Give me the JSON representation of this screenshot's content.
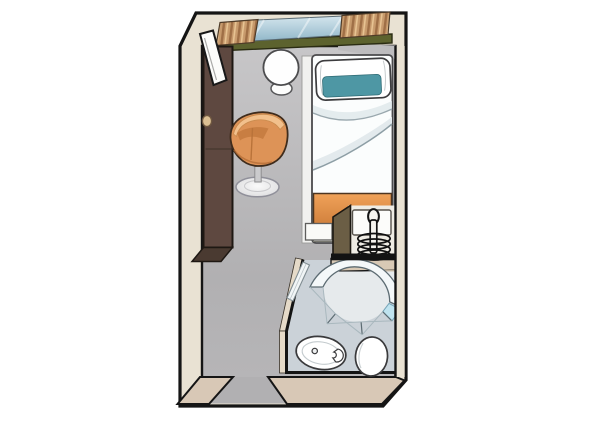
{
  "palette": {
    "background": "#ffffff",
    "wall_fill": "#e9e2d3",
    "wall_outline": "#151515",
    "wall_bottom": "#d8c8b6",
    "floor_top": "#c7c6c8",
    "floor_bottom": "#b1b0b2",
    "inner_face_gray": "#bdbcbe",
    "window_glass_top": "#d5e6ee",
    "window_glass_bottom": "#8fb6c8",
    "window_sill": "#5c622e",
    "curtain_base": "#c79a6c",
    "curtain_stripe": "#9f6f46",
    "curtain_light": "#e7c392",
    "wardrobe": "#5e4840",
    "wardrobe_face": "#4a3a31",
    "knob": "#dcc093",
    "door_white": "#fcfcfa",
    "table_white": "#fefefe",
    "chair_body": "#dd9357",
    "chair_rim": "#f2c08c",
    "chair_seat_shadow": "#c47a3e",
    "chair_outline": "#3f2c1c",
    "pedestal": "#efeff0",
    "bed_white": "#fbfdfd",
    "bed_rail": "#f1f1ef",
    "crease": "#8d9ea5",
    "pillow_teal": "#4e97a4",
    "foot_orange_1": "#f0a259",
    "foot_orange_2": "#cb7a37",
    "radiator_olive": "#6b5e45",
    "radiator_interior": "#efece4",
    "coil_black": "#101010",
    "bath_wall": "#d8c9b5",
    "bath_wall_light": "#e5dac8",
    "bath_wall_dark": "#cfc0ab",
    "bath_floor": "#cbd2d8",
    "glass_tint": "#f4f8f9",
    "glass_line": "#5c6b72",
    "glass_cross": "#a9b8be",
    "glass_cyan": "#bfe3ef",
    "fixture_white": "#ffffff",
    "fixture_outline": "#3a3a3c"
  },
  "scene": {
    "type": "cabin-floorplan-illustration",
    "items": [
      "outer-walls",
      "bottom-wall-face",
      "entry-opening",
      "window",
      "curtain-left",
      "curtain-right",
      "window-sill",
      "open-door-leaf",
      "wardrobe",
      "wardrobe-knob",
      "side-table",
      "tub-chair",
      "chair-pedestal",
      "single-bed",
      "pillow",
      "duvet",
      "bed-footboard",
      "radiator-unit",
      "coil",
      "bathroom",
      "shower-enclosure",
      "shower-door",
      "washbasin",
      "toilet"
    ]
  }
}
